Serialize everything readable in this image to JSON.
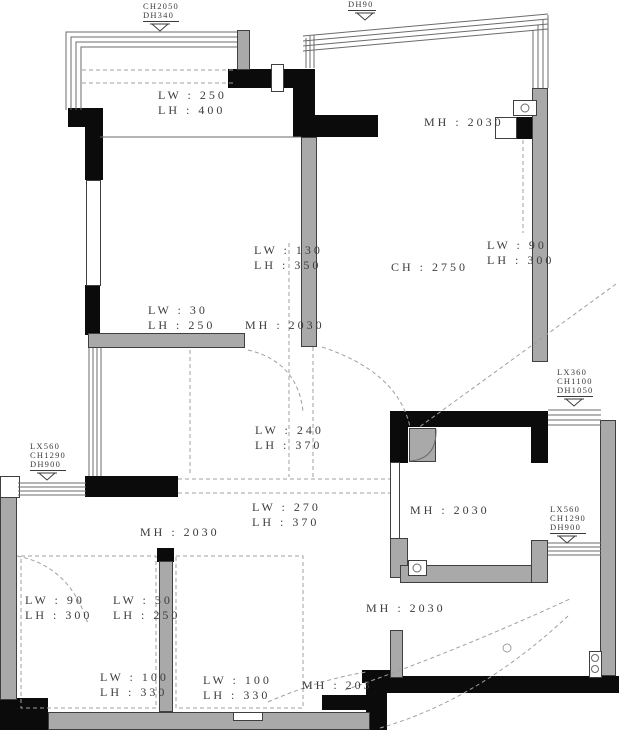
{
  "title": "residential floor plan with beam, ceiling and opening dimensions",
  "colors": {
    "wall_black": "#0b0b0b",
    "wall_gray": "#a9a9a9",
    "wall_outline": "#3f3f3f",
    "line": "#6b6b6b",
    "dash": "#9f9f9f",
    "text": "#3c3c3c",
    "bg": "#ffffff"
  },
  "labels": {
    "s1": {
      "l1": "LX300",
      "l2": "CH2050",
      "l3": "DH340"
    },
    "s2": {
      "l1": "DH90"
    },
    "s3": {
      "l1": "LX360",
      "l2": "CH1100",
      "l3": "DH1050"
    },
    "s4": {
      "l1": "LX560",
      "l2": "CH1290",
      "l3": "DH900"
    },
    "s5": {
      "l1": "LX560",
      "l2": "CH1290",
      "l3": "DH900"
    },
    "n1": {
      "l1": "LW : 250",
      "l2": "LH : 400"
    },
    "n2": {
      "l1": "MH : 2030"
    },
    "n3": {
      "l1": "LW : 130",
      "l2": "LH : 350"
    },
    "n4": {
      "l1": "CH : 2750"
    },
    "n5": {
      "l1": "LW : 90",
      "l2": "LH : 300"
    },
    "n6": {
      "l1": "LW : 30",
      "l2": "LH : 250"
    },
    "n7": {
      "l1": "MH : 2030"
    },
    "n8": {
      "l1": "LW : 240",
      "l2": "LH : 370"
    },
    "n9": {
      "l1": "LW : 270",
      "l2": "LH : 370"
    },
    "n10": {
      "l1": "MH : 2030"
    },
    "n11": {
      "l1": "MH : 2030"
    },
    "n12": {
      "l1": "LW : 90",
      "l2": "LH : 300"
    },
    "n13": {
      "l1": "LW : 30",
      "l2": "LH : 250"
    },
    "n14": {
      "l1": "MH : 2030"
    },
    "n15": {
      "l1": "LW : 100",
      "l2": "LH : 330"
    },
    "n16": {
      "l1": "LW : 100",
      "l2": "LH : 330"
    },
    "n17": {
      "l1": "MH : 203"
    }
  }
}
